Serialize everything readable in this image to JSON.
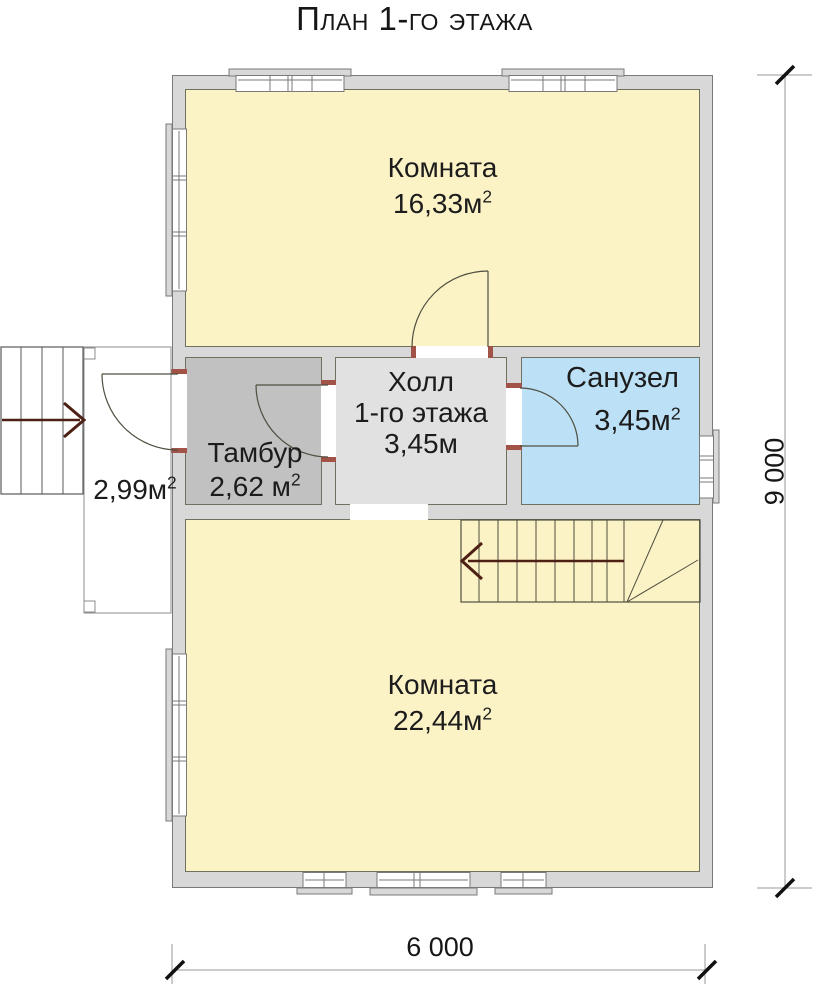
{
  "title": "План 1-го этажа",
  "rooms": {
    "room_top": {
      "label": "Комната",
      "area": "16,33м",
      "area_sup": "2",
      "color": "#fbf2c5"
    },
    "tambur": {
      "label": "Тамбур",
      "area": "2,62 м",
      "area_sup": "2",
      "color": "#c1c1c1"
    },
    "hall": {
      "label": "Холл",
      "label2": "1-го этажа",
      "area": "3,45м",
      "area_sup": "",
      "color": "#e1e1e1"
    },
    "sanuzel": {
      "label": "Санузел",
      "area": "3,45м",
      "area_sup": "2",
      "color": "#bce0f5"
    },
    "room_bottom": {
      "label": "Комната",
      "area": "22,44м",
      "area_sup": "2",
      "color": "#fbf2c5"
    },
    "porch": {
      "area": "2,99м",
      "area_sup": "2"
    }
  },
  "dimensions": {
    "vertical": "9 000",
    "horizontal": "6 000"
  },
  "colors": {
    "wall_fill": "#d8d8d8",
    "wall_line": "#7a7a7a",
    "room_yellow": "#fbf2c5",
    "tambur_gray": "#c1c1c1",
    "hall_gray": "#e1e1e1",
    "sanuzel_blue": "#bce0f5",
    "door_jamb": "#a35248",
    "stairs_arrow": "#4d2015"
  }
}
